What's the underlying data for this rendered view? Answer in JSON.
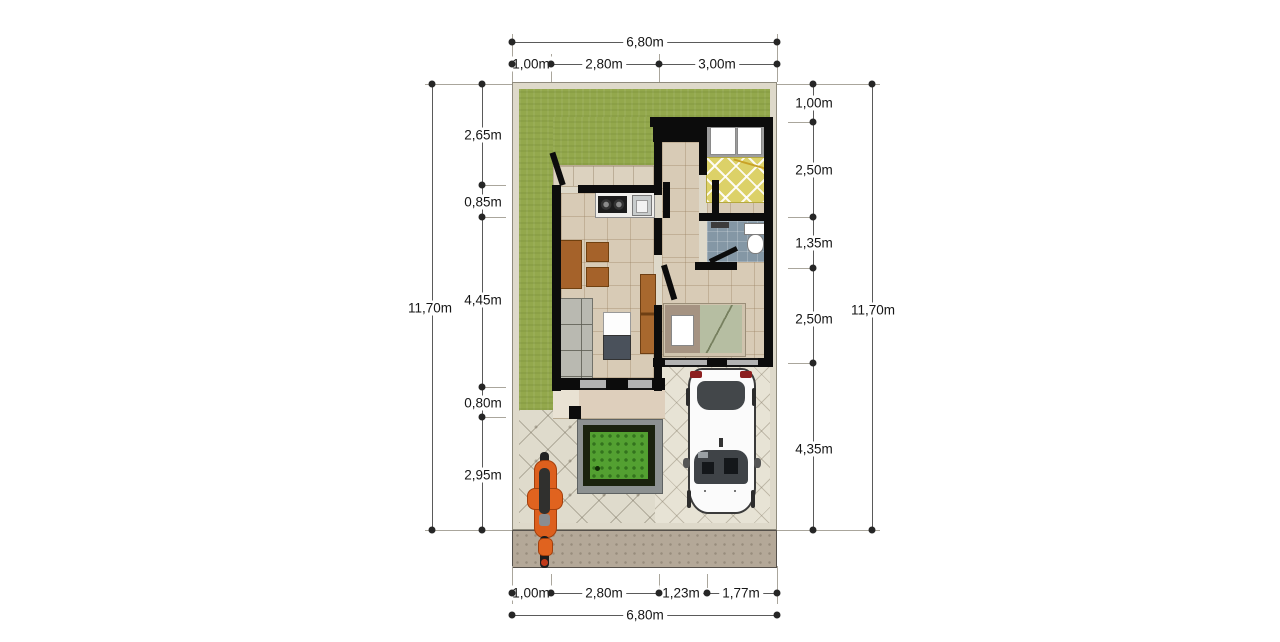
{
  "figure": {
    "type": "house-floor-plan",
    "units": "m"
  },
  "dimensions": {
    "top": {
      "overall": "6,80m",
      "segments": [
        "1,00m",
        "2,80m",
        "3,00m"
      ]
    },
    "bottom": {
      "overall": "6,80m",
      "segments": [
        "1,00m",
        "2,80m",
        "1,23m",
        "1,77m"
      ]
    },
    "left": {
      "overall": "11,70m",
      "segments": [
        "2,65m",
        "0,85m",
        "4,45m",
        "0,80m",
        "2,95m"
      ]
    },
    "right": {
      "overall": "11,70m",
      "segments": [
        "1,00m",
        "2,50m",
        "1,35m",
        "2,50m",
        "4,35m"
      ]
    }
  },
  "plan": {
    "areas": [
      "lawn",
      "kitchen",
      "living-room",
      "hallway",
      "bedroom-1",
      "bathroom",
      "bedroom-2",
      "porch",
      "terrace",
      "carport",
      "garden-patch",
      "sidewalk"
    ],
    "objects": [
      "double-bed",
      "single-bed",
      "sofa",
      "coffee-table",
      "side-tables",
      "cabinet",
      "stove",
      "kitchen-sink",
      "toilet",
      "car",
      "motorcycle",
      "porch-column"
    ]
  },
  "colors": {
    "lawn": "#93a84c",
    "wall": "#0c0c0c",
    "floor_tile": "#d8cbb6",
    "paving": "#dfdbcc",
    "bath_tile": "#8497a5",
    "bed1_blanket": "#dcd168",
    "bed2_blanket": "#b6bea2",
    "wood_furniture": "#a5622a",
    "motorcycle": "#e0631f",
    "grass_patch": "#53a031",
    "sidewalk": "#b4a898",
    "plot_border": "#ded9ca",
    "dimension_text": "#161616"
  }
}
